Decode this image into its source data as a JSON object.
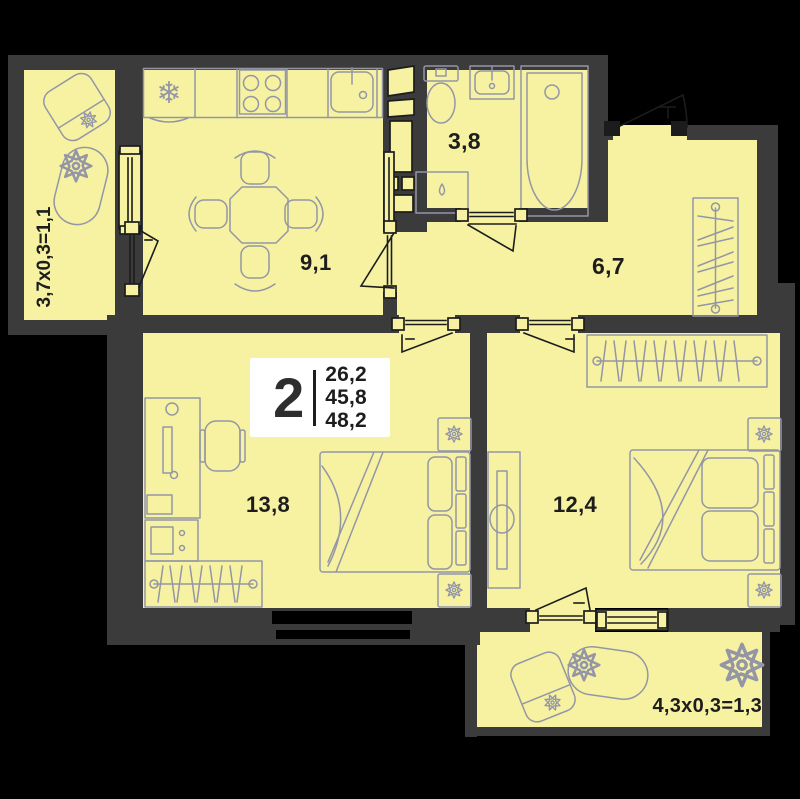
{
  "plan": {
    "info_box": {
      "rooms_count": "2",
      "area_living": "26,2",
      "area_apartment": "45,8",
      "area_total": "48,2"
    },
    "rooms": {
      "kitchen": {
        "label": "9,1"
      },
      "bathroom": {
        "label": "3,8"
      },
      "hallway": {
        "label": "6,7"
      },
      "bedroom_small": {
        "label": "13,8"
      },
      "bedroom_large": {
        "label": "12,4"
      },
      "balcony_left": {
        "label": "3,7x0,3=1,1"
      },
      "balcony_bottom": {
        "label": "4,3x0,3=1,3"
      }
    },
    "icons": {
      "fridge_snowflake": "❄"
    },
    "colors": {
      "background": "#000000",
      "wall": "#3b3b3b",
      "room_fill": "#f6f2a2",
      "furniture_stroke": "#9496a6",
      "door_stroke": "#1c1c1c",
      "info_box_bg": "#ffffff",
      "text": "#1d1d1d"
    }
  }
}
